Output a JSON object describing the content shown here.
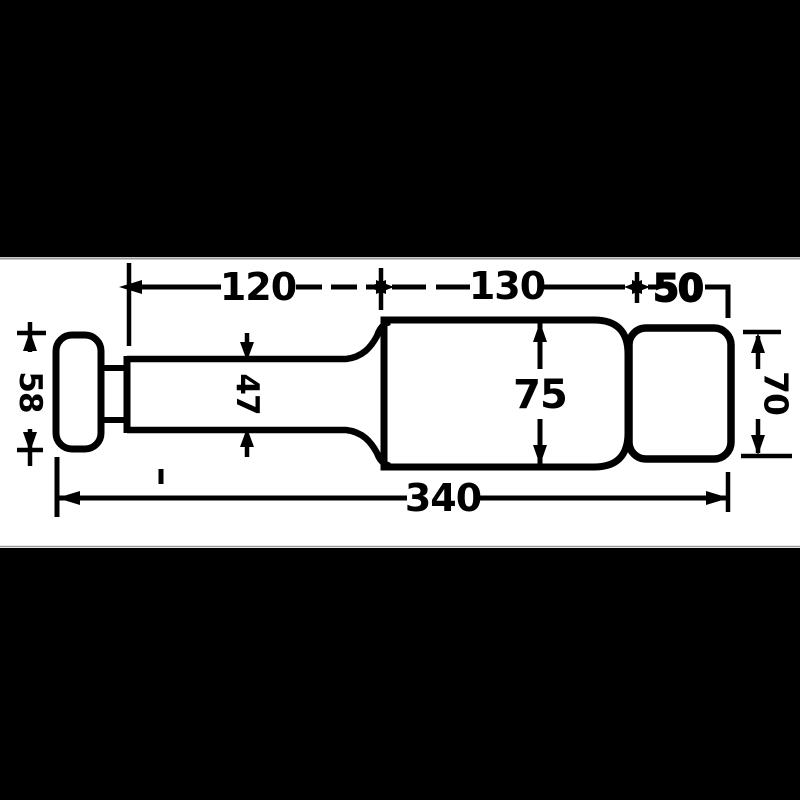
{
  "drawing": {
    "colors": {
      "ink": "#000000",
      "paper": "#ffffff",
      "letterbox_bar": "#000000"
    },
    "dim_labels": {
      "top_left_length": "120",
      "top_mid_length": "130",
      "top_right_length": "50",
      "body_diameter": "75",
      "overall_length": "340",
      "shaft_diameter": "47",
      "knob_diameter": "58",
      "cap_diameter": "70"
    }
  }
}
